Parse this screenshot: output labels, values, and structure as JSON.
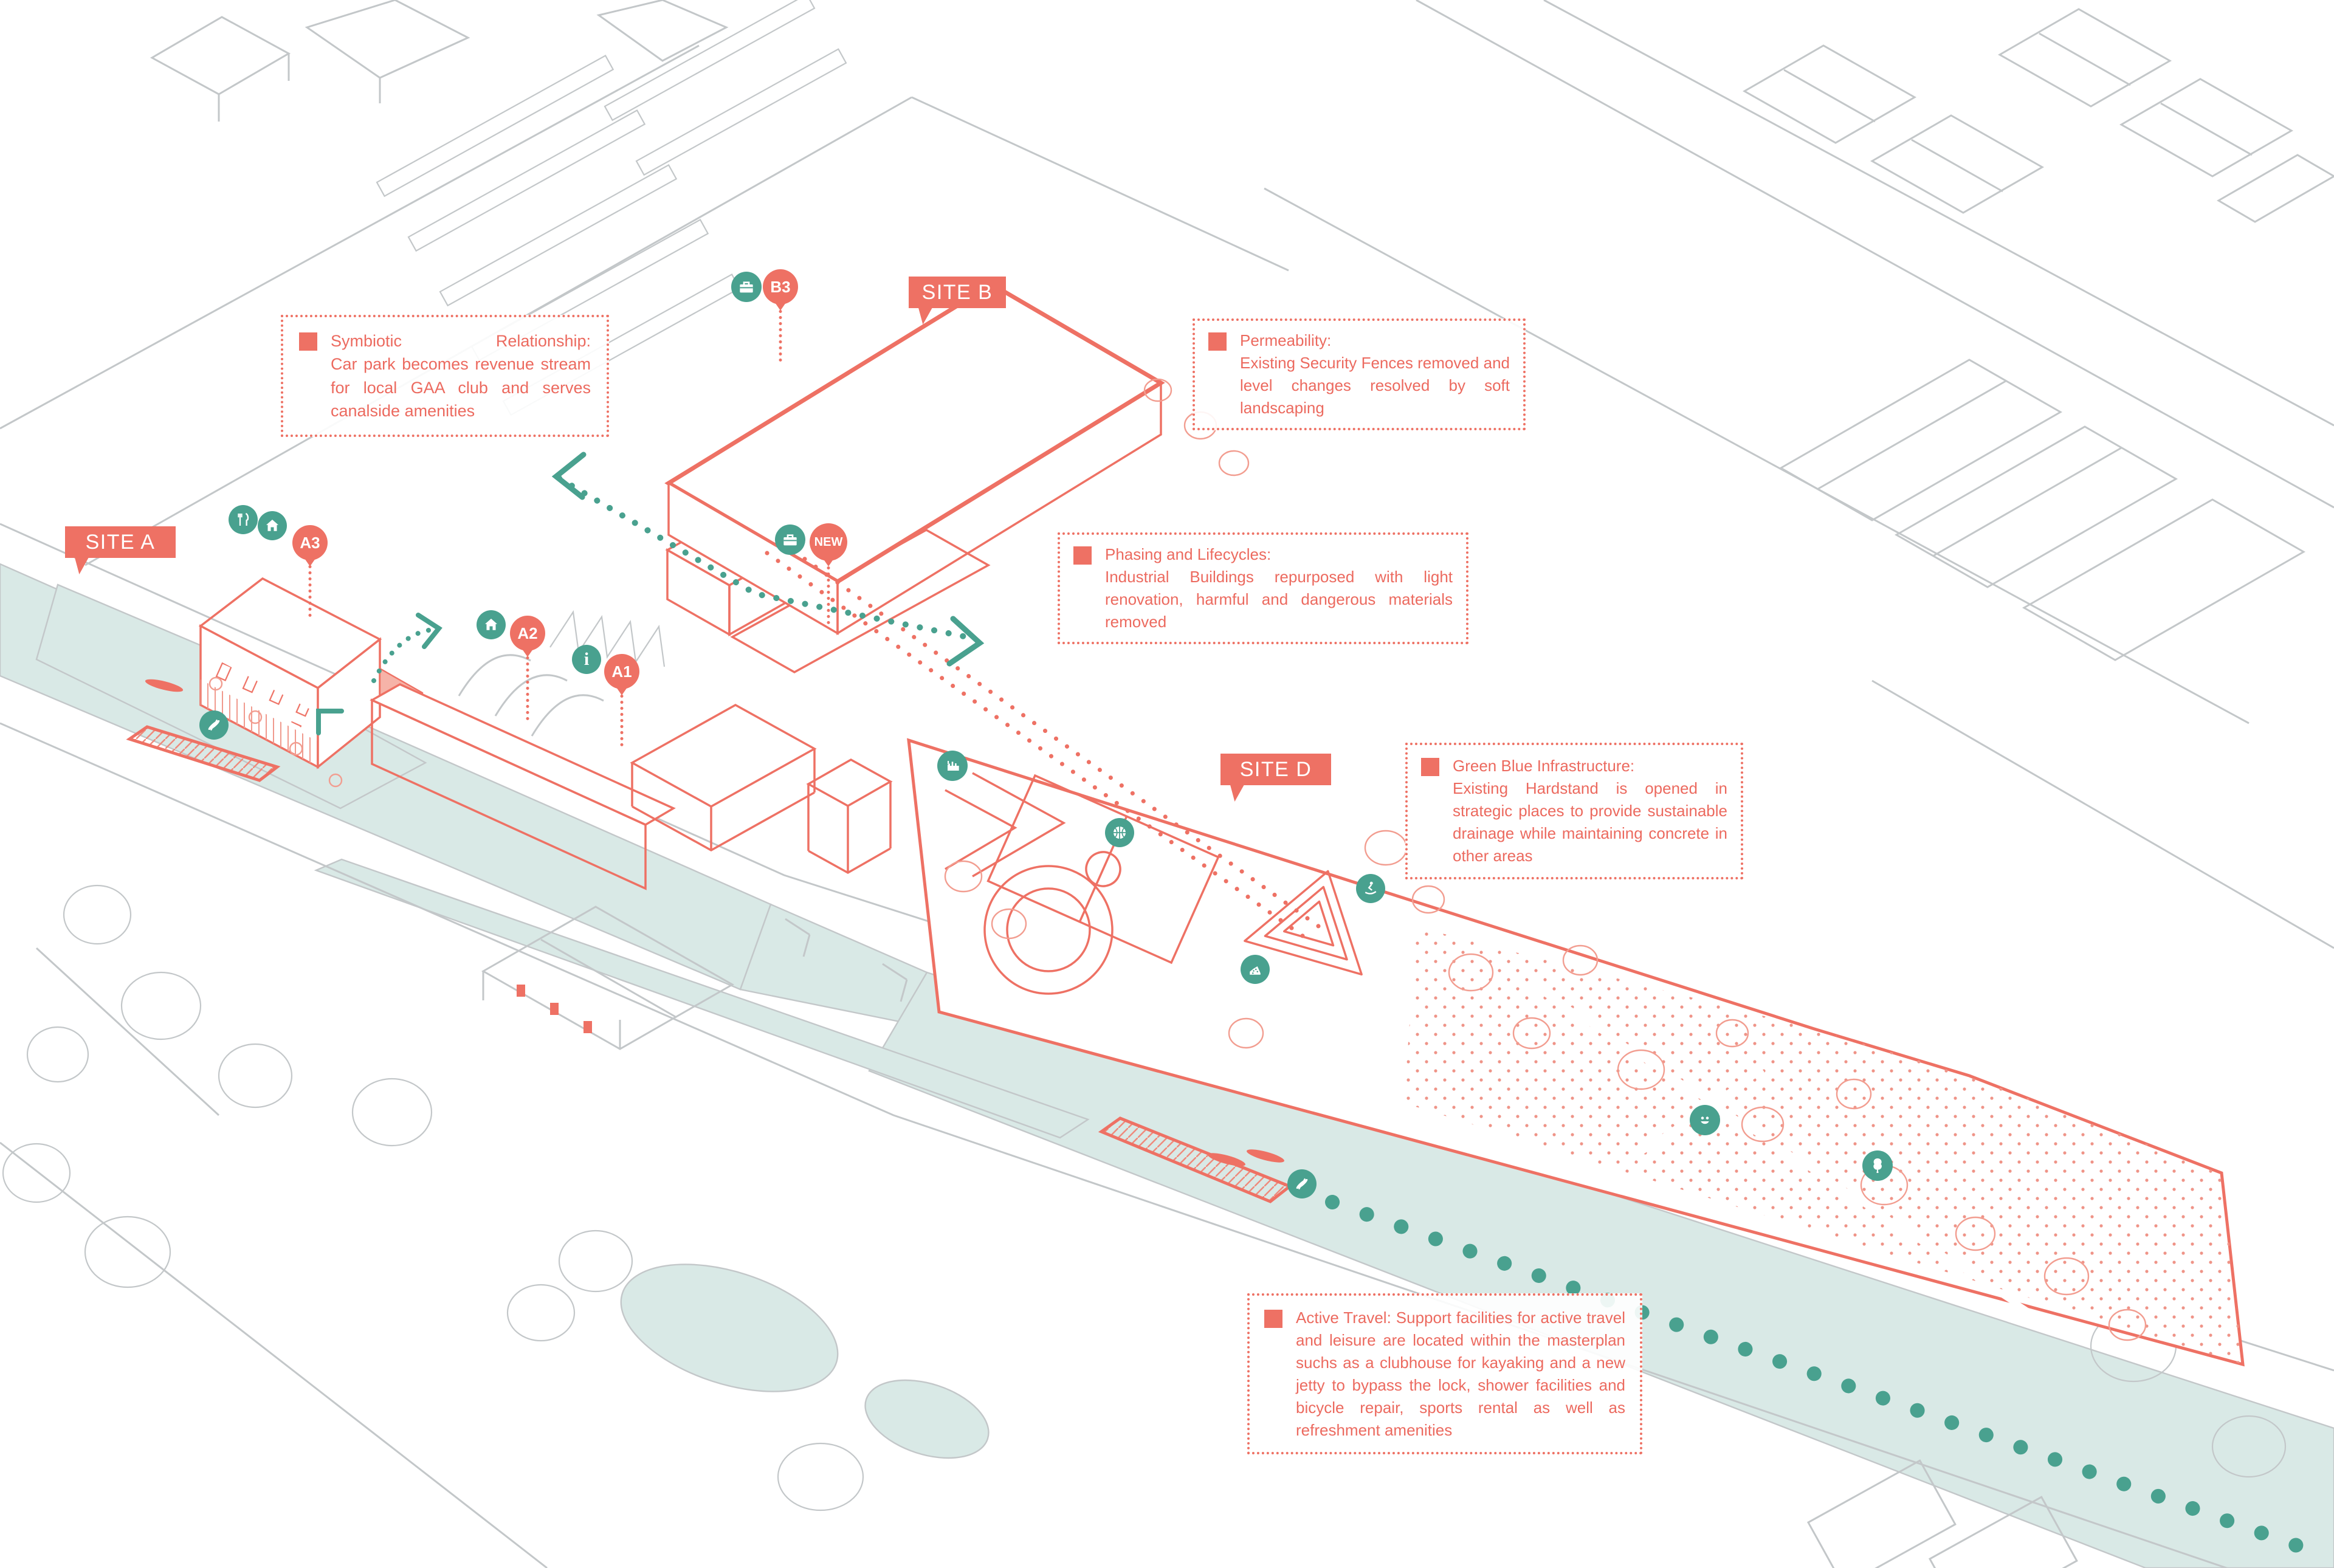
{
  "colors": {
    "salmon": "#ee7164",
    "salmon_text": "#ec6a5f",
    "salmon_light": "#f29d90",
    "teal": "#49a18f",
    "water": "#d9e9e6",
    "gray_line": "#c3c7c9"
  },
  "sites": {
    "a": "SITE A",
    "b": "SITE B",
    "d": "SITE D"
  },
  "markers": {
    "b3": "B3",
    "a3": "A3",
    "a2": "A2",
    "a1": "A1",
    "new": "NEW",
    "info": "i"
  },
  "icons": [
    "briefcase-icon",
    "restaurant-icon",
    "home-icon",
    "home-icon",
    "briefcase-icon",
    "kayak-icon",
    "industry-icon",
    "basketball-icon",
    "skateboard-icon",
    "climbing-icon",
    "kayak-icon",
    "smiley-icon",
    "tree-icon"
  ],
  "annotations": [
    {
      "id": "symbiotic",
      "title": "Symbiotic Relationship:",
      "body": "Car park becomes revenue stream for local GAA club and serves canalside amenities"
    },
    {
      "id": "permeability",
      "title": "Permeability:",
      "body": "Existing Security Fences removed and level changes resolved by soft landscaping"
    },
    {
      "id": "phasing",
      "title": "Phasing and Lifecycles:",
      "body": "Industrial Buildings repurposed with light renovation, harmful and dangerous materials removed"
    },
    {
      "id": "green-blue",
      "title": "Green Blue Infrastructure:",
      "body": "Existing Hardstand is opened in strategic places to provide sustainable drainage while maintaining concrete in other areas"
    },
    {
      "id": "active-travel",
      "title": "Active Travel:",
      "body": "Support facilities for active travel and leisure are located within the masterplan suchs as a clubhouse for kayaking and a new jetty to bypass the lock, shower facilities and bicycle repair, sports rental as well as refreshment amenities"
    }
  ]
}
